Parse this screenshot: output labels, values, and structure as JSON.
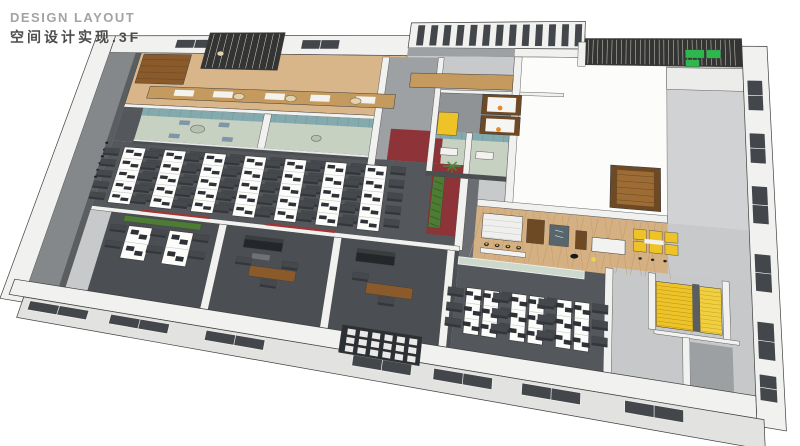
{
  "header": {
    "title_en": "DESIGN LAYOUT",
    "title_cn": "空间设计实现.3F"
  },
  "floor": "3F",
  "palette": {
    "base": "#c7c9ca",
    "wall_white": "#f1f1ef",
    "wall_face": "#e2e2e0",
    "wall_gray": "#9ea1a3",
    "wall_dark": "#4b4f52",
    "left_face": "#84888b",
    "left_edge": "#5a5e61",
    "carpet": "#54585c",
    "carpet_dark": "#4b4f53",
    "tan": "#d8b68a",
    "herring": "#d5b083",
    "herring_line": "#bf9865",
    "wood": "#8a5a2b",
    "wood_dark": "#6e4a24",
    "wood_mid": "#9c6c34",
    "green_floor": "#c7d1c2",
    "curtain": "#85aaae",
    "glass": "#cdd9cd",
    "table_green": "#b6c1b1",
    "red_floor": "#8e3338",
    "red_wall": "#a23434",
    "yellow": "#eec328",
    "yellow_lt": "#f0d040",
    "plant": "#4d7d35",
    "sofa_green": "#2db84e",
    "slat": "#343432",
    "dark": "#2e3236",
    "chair": "#45494d",
    "chair_back": "#33373b",
    "desk": "#fcfcfb",
    "orange": "#e8872a",
    "stool_yellow": "#eebd2a",
    "ink": "#3f3f3f",
    "shelf_dark": "#2c2f33",
    "window": "#43474b",
    "sofa_black": "#24272a",
    "lamp": "#ead64e",
    "person": "#17191c",
    "board": "#57666d"
  },
  "offices": {
    "main": {
      "bench_columns": 7,
      "desks_per_column": 5
    },
    "east": {
      "clusters": 3,
      "desks_per_cluster": 6
    },
    "private": {
      "benches": 2,
      "desks_per_bench": 2
    }
  },
  "zones": [
    {
      "id": "pantry",
      "label": "Pantry / Tea Area"
    },
    {
      "id": "trellis",
      "label": "Wood Trellis Shelf"
    },
    {
      "id": "meeting-a",
      "label": "Meeting Room A"
    },
    {
      "id": "meeting-b",
      "label": "Meeting Room B"
    },
    {
      "id": "meeting-c",
      "label": "Meeting Room C"
    },
    {
      "id": "meeting-d",
      "label": "Meeting Room D"
    },
    {
      "id": "corridor",
      "label": "Corridor"
    },
    {
      "id": "elevator-lobby",
      "label": "Elevator Lobby"
    },
    {
      "id": "red-lobby",
      "label": "Red Carpet Lobby"
    },
    {
      "id": "open-office-main",
      "label": "Main Open Office"
    },
    {
      "id": "open-office-east",
      "label": "East Open Office"
    },
    {
      "id": "private-office-1",
      "label": "Private Office 1"
    },
    {
      "id": "executive-office-1",
      "label": "Executive Office 1"
    },
    {
      "id": "executive-office-2",
      "label": "Executive Office 2"
    },
    {
      "id": "lounge",
      "label": "Cafe Lounge"
    },
    {
      "id": "bar-counter",
      "label": "Bar Counter"
    },
    {
      "id": "booth-seating",
      "label": "Booth Seating"
    },
    {
      "id": "staircase",
      "label": "Staircase"
    },
    {
      "id": "terrace",
      "label": "Slatted Roof Terrace"
    },
    {
      "id": "roof-void",
      "label": "Roof Void"
    },
    {
      "id": "display-shelf",
      "label": "Display Shelf Wall"
    },
    {
      "id": "restrooms",
      "label": "Restrooms"
    },
    {
      "id": "front-facade",
      "label": "Front Facade"
    },
    {
      "id": "east-facade",
      "label": "East Facade"
    }
  ]
}
